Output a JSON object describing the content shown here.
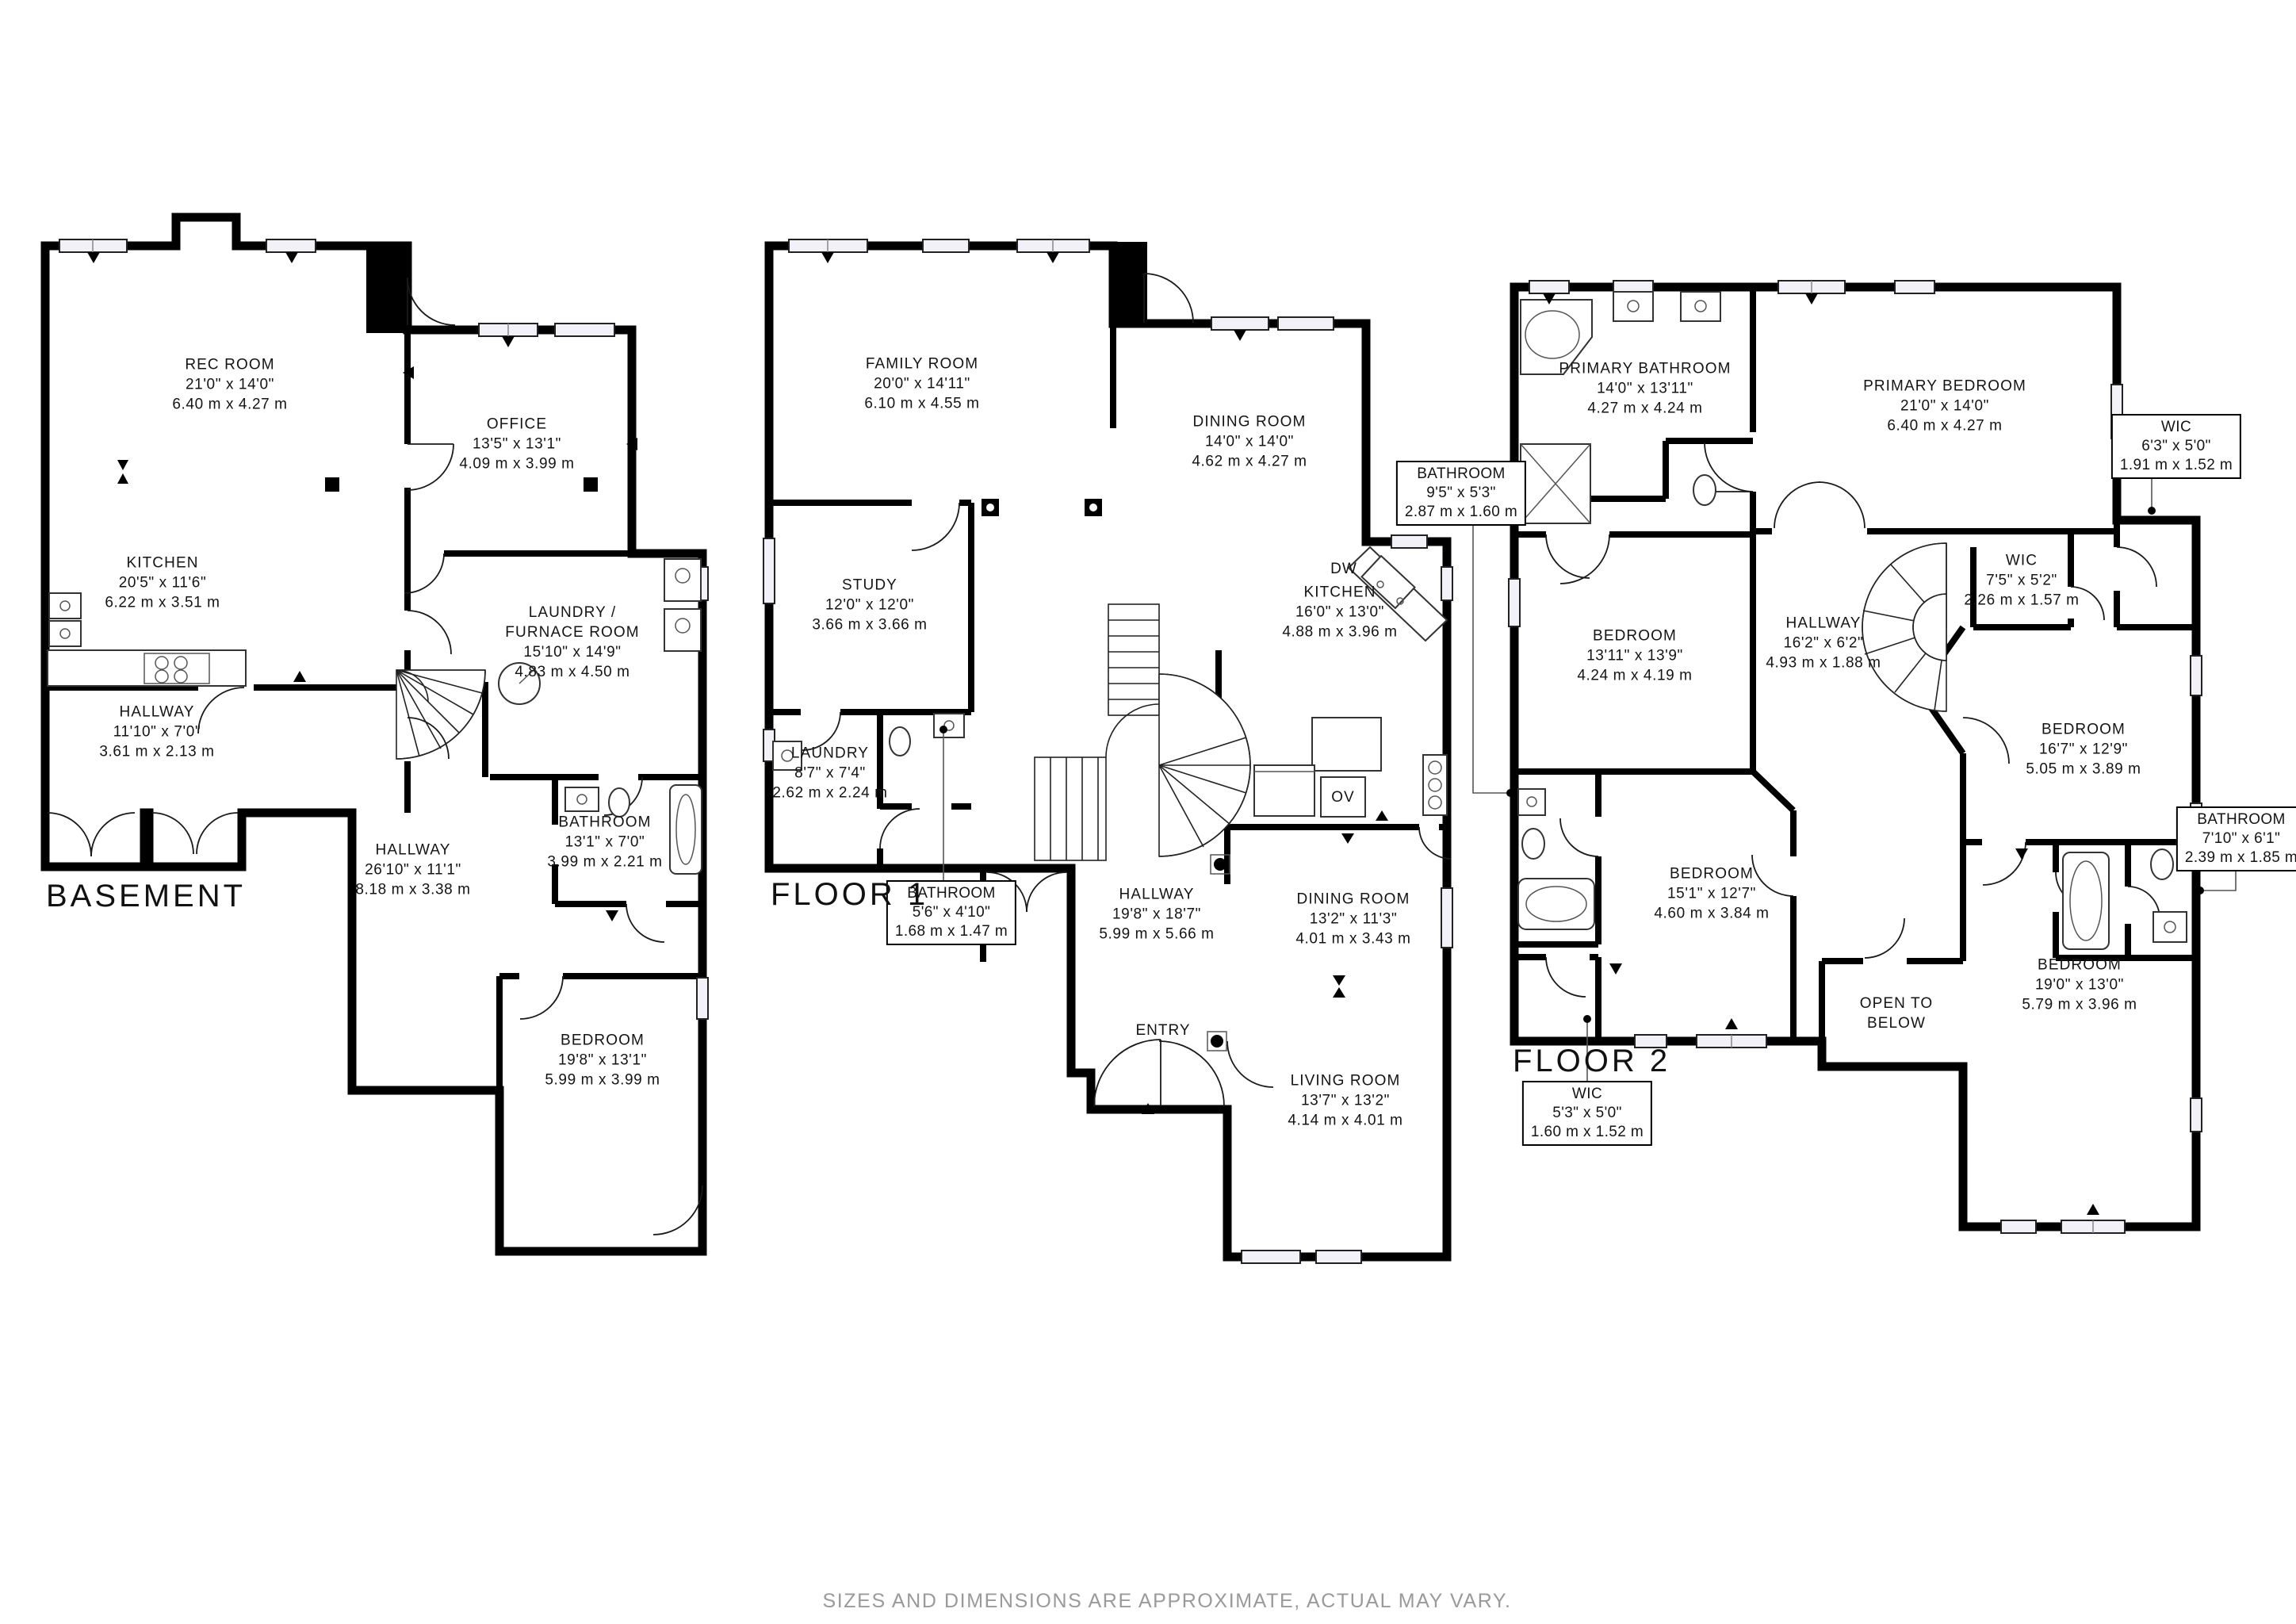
{
  "footer": {
    "disclaimer": "SIZES AND DIMENSIONS ARE APPROXIMATE, ACTUAL MAY VARY."
  },
  "floors": {
    "basement": {
      "title": "BASEMENT",
      "rooms": {
        "rec": {
          "name": "REC ROOM",
          "ft": "21'0\" x 14'0\"",
          "m": "6.40 m x 4.27 m"
        },
        "office": {
          "name": "OFFICE",
          "ft": "13'5\" x 13'1\"",
          "m": "4.09 m x 3.99 m"
        },
        "kitchen": {
          "name": "KITCHEN",
          "ft": "20'5\" x 11'6\"",
          "m": "6.22 m x 3.51 m"
        },
        "laundry": {
          "name": "LAUNDRY /",
          "name2": "FURNACE ROOM",
          "ft": "15'10\" x 14'9\"",
          "m": "4.83 m x 4.50 m"
        },
        "hallway1": {
          "name": "HALLWAY",
          "ft": "11'10\" x 7'0\"",
          "m": "3.61 m x 2.13 m"
        },
        "hallway2": {
          "name": "HALLWAY",
          "ft": "26'10\" x 11'1\"",
          "m": "8.18 m x 3.38 m"
        },
        "bathroom": {
          "name": "BATHROOM",
          "ft": "13'1\" x 7'0\"",
          "m": "3.99 m x 2.21 m"
        },
        "bedroom": {
          "name": "BEDROOM",
          "ft": "19'8\" x 13'1\"",
          "m": "5.99 m x 3.99 m"
        }
      }
    },
    "floor1": {
      "title": "FLOOR 1",
      "rooms": {
        "family": {
          "name": "FAMILY ROOM",
          "ft": "20'0\" x 14'11\"",
          "m": "6.10 m x 4.55 m"
        },
        "dining1": {
          "name": "DINING ROOM",
          "ft": "14'0\" x 14'0\"",
          "m": "4.62 m x 4.27 m"
        },
        "study": {
          "name": "STUDY",
          "ft": "12'0\" x 12'0\"",
          "m": "3.66 m x 3.66 m"
        },
        "kitchen": {
          "name": "KITCHEN",
          "ft": "16'0\" x 13'0\"",
          "m": "4.88 m x 3.96 m"
        },
        "laundry": {
          "name": "LAUNDRY",
          "ft": "8'7\" x 7'4\"",
          "m": "2.62 m x 2.24 m"
        },
        "hallway": {
          "name": "HALLWAY",
          "ft": "19'8\" x 18'7\"",
          "m": "5.99 m x 5.66 m"
        },
        "dining2": {
          "name": "DINING ROOM",
          "ft": "13'2\" x 11'3\"",
          "m": "4.01 m x 3.43 m"
        },
        "living": {
          "name": "LIVING ROOM",
          "ft": "13'7\" x 13'2\"",
          "m": "4.14 m x 4.01 m"
        }
      },
      "callouts": {
        "bathroom": {
          "name": "BATHROOM",
          "ft": "5'6\" x 4'10\"",
          "m": "1.68 m x 1.47 m"
        }
      },
      "labels": {
        "dw": "DW",
        "ov": "OV",
        "entry": "ENTRY"
      }
    },
    "floor2": {
      "title": "FLOOR 2",
      "rooms": {
        "pbath": {
          "name": "PRIMARY BATHROOM",
          "ft": "14'0\" x 13'11\"",
          "m": "4.27 m x 4.24 m"
        },
        "pbed": {
          "name": "PRIMARY BEDROOM",
          "ft": "21'0\" x 14'0\"",
          "m": "6.40 m x 4.27 m"
        },
        "wicmid": {
          "name": "WIC",
          "ft": "7'5\" x 5'2\"",
          "m": "2.26 m x 1.57 m"
        },
        "bed1": {
          "name": "BEDROOM",
          "ft": "13'11\" x 13'9\"",
          "m": "4.24 m x 4.19 m"
        },
        "hallway": {
          "name": "HALLWAY",
          "ft": "16'2\" x 6'2\"",
          "m": "4.93 m x 1.88 m"
        },
        "bed2": {
          "name": "BEDROOM",
          "ft": "16'7\" x 12'9\"",
          "m": "5.05 m x 3.89 m"
        },
        "bed3": {
          "name": "BEDROOM",
          "ft": "15'1\" x 12'7\"",
          "m": "4.60 m x 3.84 m"
        },
        "bed4": {
          "name": "BEDROOM",
          "ft": "19'0\" x 13'0\"",
          "m": "5.79 m x 3.96 m"
        },
        "open": {
          "name": "OPEN TO",
          "name2": "BELOW"
        }
      },
      "callouts": {
        "wicright": {
          "name": "WIC",
          "ft": "6'3\" x 5'0\"",
          "m": "1.91 m x 1.52 m"
        },
        "bathleft": {
          "name": "BATHROOM",
          "ft": "9'5\" x 5'3\"",
          "m": "2.87 m x 1.60 m"
        },
        "bathright": {
          "name": "BATHROOM",
          "ft": "7'10\" x 6'1\"",
          "m": "2.39 m x 1.85 m"
        },
        "wicbottom": {
          "name": "WIC",
          "ft": "5'3\" x 5'0\"",
          "m": "1.60 m x 1.52 m"
        }
      }
    }
  }
}
